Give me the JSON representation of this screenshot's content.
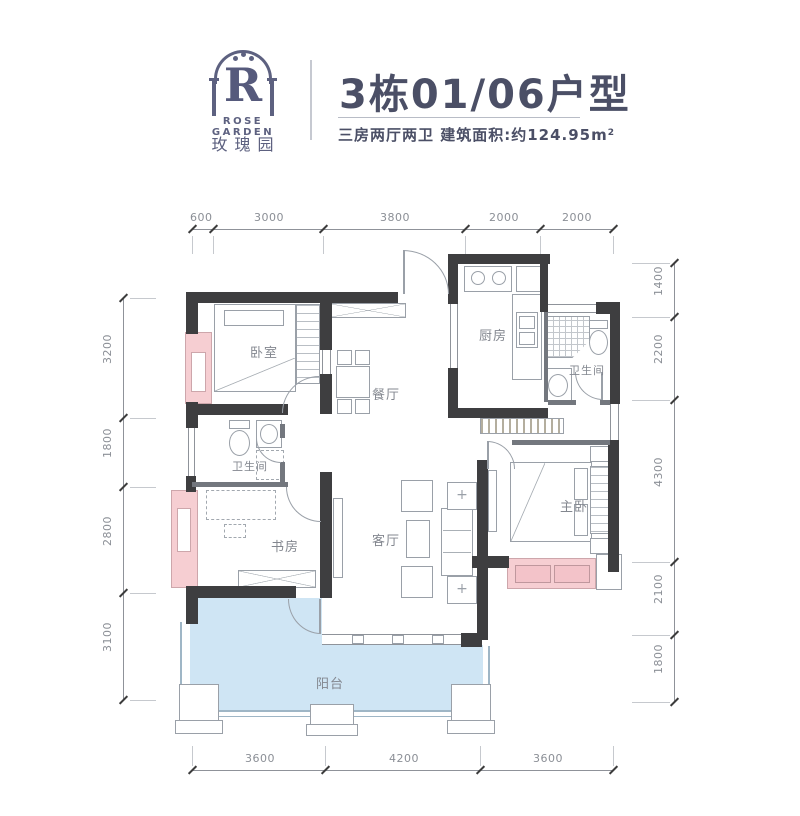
{
  "header": {
    "logo": {
      "letter": "R",
      "name_en": "ROSE GARDEN",
      "name_cn": "玫瑰园"
    },
    "title": "3栋01/06户型",
    "subtitle": "三房两厅两卫 建筑面积:约124.95",
    "area_unit": "m",
    "area_sup": "2"
  },
  "rooms": {
    "bedroom": "卧室",
    "dining": "餐厅",
    "kitchen": "厨房",
    "bath_top": "卫生间",
    "bath_mid": "卫生间",
    "study": "书房",
    "living": "客厅",
    "master": "主卧",
    "balcony": "阳台"
  },
  "dims": {
    "top": [
      "600",
      "3000",
      "3800",
      "2000",
      "2000"
    ],
    "left": [
      "3200",
      "1800",
      "2800",
      "3100"
    ],
    "right": [
      "1400",
      "2200",
      "4300",
      "2100",
      "1800"
    ],
    "bottom": [
      "3600",
      "4200",
      "3600"
    ]
  },
  "icons": {
    "plant": "+"
  },
  "colors": {
    "wall": "#3e3e40",
    "window_pink": "#f6ced2",
    "balcony_blue": "#cfe5f4",
    "brand_navy": "#565a7c",
    "dim_gray": "#8b8f96"
  }
}
